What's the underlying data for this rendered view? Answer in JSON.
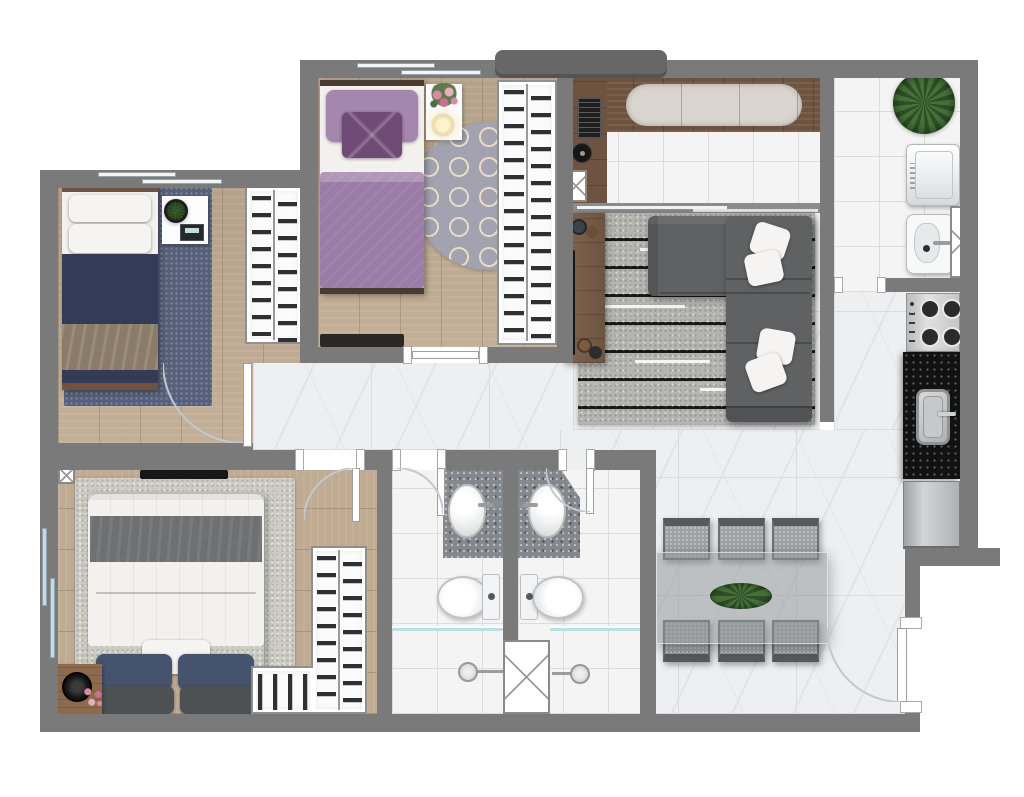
{
  "meta": {
    "kind": "apartment-floor-plan-render",
    "view": "top-down",
    "visible_text": []
  },
  "palette": {
    "wall": "#7a7a7a",
    "wall_dark": "#676767",
    "wood": "#c0ab92",
    "marble": "#edeff1",
    "marble_line": "#d9dde1",
    "tile": "#f4f4f4",
    "tile_line": "#dcdcdc",
    "granite": "#84888d",
    "counter_black": "#121212",
    "steel": "#c7c9cb",
    "navy": "#333b59",
    "taupe": "#8b7c6a",
    "white_linen": "#f2f1ee",
    "mauve": "#a586ad",
    "purple": "#9b7ba8",
    "purple_dark": "#6e4a74",
    "rug_blue": "#57607a",
    "rug_gray": "#ccccc5",
    "rug_round": "#a3a2b0",
    "trellis": "#e9ddc6",
    "sofa": "#5f6163",
    "sofa_dark": "#4e5052",
    "pillow_white": "#f5f4f2",
    "wood_furn": "#6e5440",
    "glass_blue": "#bfdde8",
    "plant": "#477039",
    "plant_dark": "#2f4d27",
    "fridge": "#b9bcbf",
    "table_glass": "rgba(140,145,148,0.5)",
    "chair": "#9fa2a3",
    "chair_back": "#57595b"
  },
  "rooms": [
    {
      "id": "bedroom-1",
      "label": "bedroom-1",
      "floor": "wood",
      "furniture": [
        "single-bed-navy",
        "blue-area-rug",
        "tray-side-table",
        "potted-plant",
        "book",
        "double-wardrobe",
        "wall-tv",
        "sliding-window"
      ]
    },
    {
      "id": "bedroom-2",
      "label": "bedroom-2",
      "floor": "wood",
      "furniture": [
        "single-bed-purple",
        "round-trellis-rug",
        "side-table",
        "flower-bouquet",
        "lamp",
        "double-wardrobe",
        "desk-shelf",
        "sliding-window"
      ]
    },
    {
      "id": "gourmet-balcony",
      "label": "gourmet-balcony",
      "floor": "tile",
      "furniture": [
        "wood-counter",
        "bench-cushion",
        "grill",
        "round-sink",
        "duct-shaft",
        "sliding-door"
      ]
    },
    {
      "id": "service-area",
      "label": "service-area",
      "floor": "tile",
      "furniture": [
        "potted-plant",
        "washing-machine",
        "laundry-tank",
        "duct-shaft"
      ]
    },
    {
      "id": "living-room",
      "label": "living-room",
      "floor": "marble",
      "furniture": [
        "striped-rug",
        "sectional-sofa",
        "four-throw-pillows",
        "tv-rack",
        "tv",
        "decor-plates"
      ]
    },
    {
      "id": "kitchen",
      "label": "kitchen",
      "floor": "marble",
      "furniture": [
        "gas-cooktop",
        "black-granite-counter",
        "steel-sink",
        "refrigerator"
      ]
    },
    {
      "id": "hallway",
      "label": "hallway",
      "floor": "marble",
      "furniture": []
    },
    {
      "id": "master-bedroom",
      "label": "master-bedroom",
      "floor": "wood",
      "furniture": [
        "double-bed",
        "gray-area-rug",
        "wood-side-table",
        "flower-vase",
        "l-shaped-wardrobe",
        "wall-tv",
        "sliding-window",
        "corner-shaft"
      ]
    },
    {
      "id": "bathroom-1",
      "label": "bathroom-1",
      "floor": "tile",
      "furniture": [
        "granite-vanity",
        "oval-sink",
        "toilet",
        "shower-glass",
        "shower-head"
      ]
    },
    {
      "id": "bathroom-2",
      "label": "bathroom-2",
      "floor": "tile",
      "furniture": [
        "granite-vanity-chamfered",
        "oval-sink",
        "toilet",
        "shower-glass",
        "shower-head",
        "duct-shaft"
      ]
    },
    {
      "id": "dining-room",
      "label": "dining-room",
      "floor": "marble",
      "furniture": [
        "glass-dining-table",
        "plant-centerpiece",
        "chair-1",
        "chair-2",
        "chair-3",
        "chair-4",
        "chair-5",
        "chair-6"
      ]
    }
  ],
  "openings": {
    "windows": [
      "bedroom-1-top-wall",
      "bedroom-2-top-wall",
      "master-bedroom-left-wall"
    ],
    "interior_doors": [
      "bedroom-1-door",
      "bedroom-2-door",
      "master-bedroom-door",
      "bathroom-1-door",
      "bathroom-2-door",
      "service-door"
    ],
    "entry_door": "right-wall-bottom",
    "balcony_sliding_door": "living-room-top"
  }
}
